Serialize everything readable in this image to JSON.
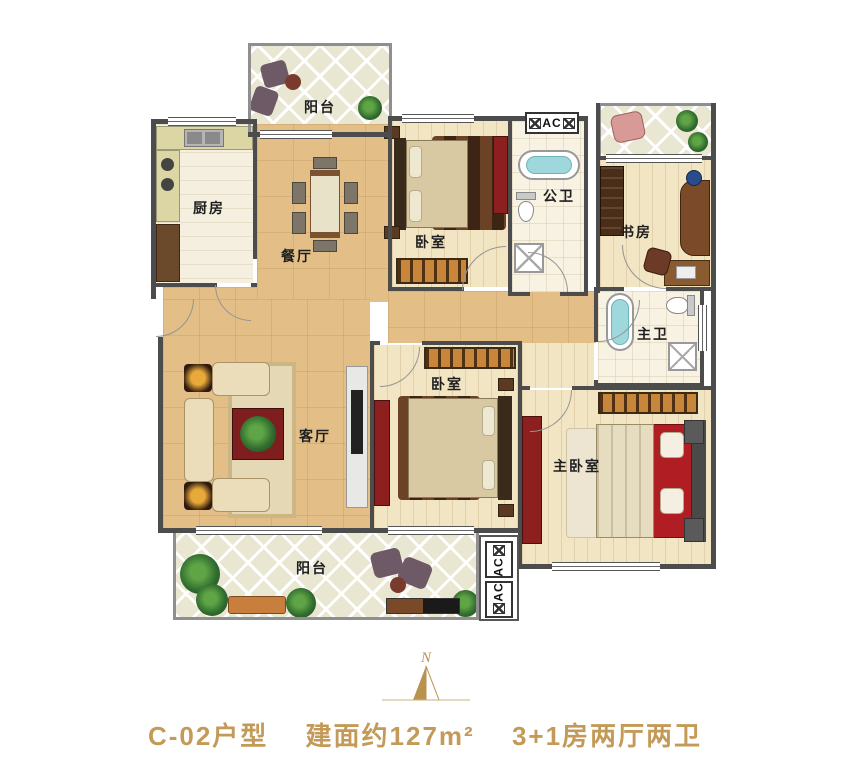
{
  "caption": {
    "unit": "C-02户型",
    "area": "建面约127m²",
    "layout": "3+1房两厅两卫"
  },
  "compass": {
    "north": "N"
  },
  "rooms": {
    "balcony_top": {
      "label": "阳台"
    },
    "kitchen": {
      "label": "厨房"
    },
    "dining": {
      "label": "餐厅"
    },
    "bedroom_top": {
      "label": "卧室"
    },
    "public_bath": {
      "label": "公卫"
    },
    "study": {
      "label": "书房"
    },
    "master_bath": {
      "label": "主卫"
    },
    "living": {
      "label": "客厅"
    },
    "bedroom_mid": {
      "label": "卧室"
    },
    "master_bedroom": {
      "label": "主卧室"
    },
    "balcony_bottom": {
      "label": "阳台"
    }
  },
  "ac": {
    "top": "AC",
    "right_upper": "AC",
    "right_lower": "AC"
  },
  "colors": {
    "accent_gold": "#C49A58",
    "compass_gold": "#B9924D",
    "wall": "#4C4C4C",
    "floor_tan": "#E3BE86",
    "floor_wood": "#F2E5C3",
    "balcony_tile": "#E9E6D1",
    "tub_water": "#9FD8DC",
    "cabinet_red": "#8E1F1F"
  }
}
